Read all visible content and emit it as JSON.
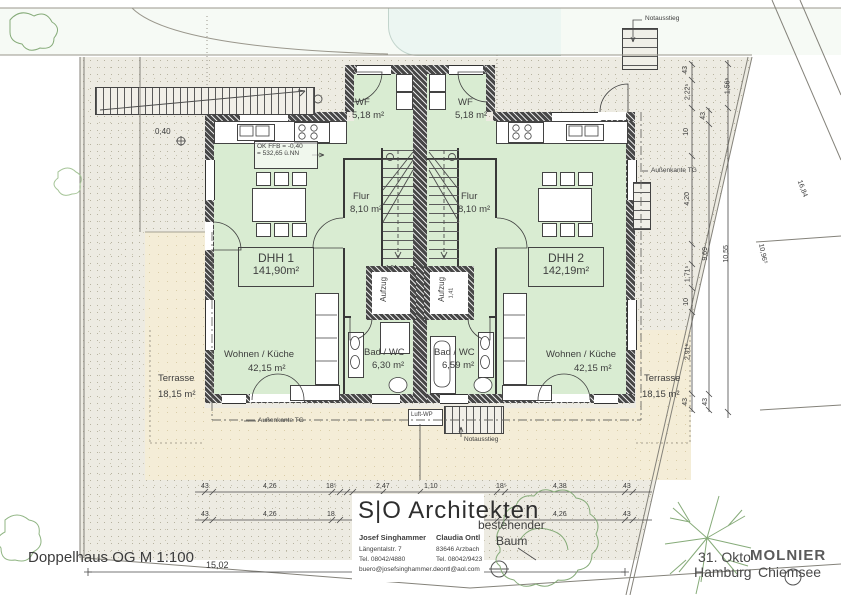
{
  "page": {
    "plan_title": "Doppelhaus OG M 1:100"
  },
  "title_block": {
    "firm": "S|O Architekten",
    "architect1": {
      "name": "Josef Singhammer",
      "line1": "Längentalstr. 7",
      "line2": "Tel. 08042/4880",
      "line3": "buero@josefsinghammer.de"
    },
    "architect2": {
      "name": "Claudia Ontl",
      "line1": "83646 Arzbach",
      "line2": "Tel. 08042/9423",
      "line3": "ontl@aol.com"
    }
  },
  "stamp": {
    "date": "31. Okto",
    "name": "MOLNIER",
    "loc1": "Hamburg",
    "loc2": "Chiemsee"
  },
  "site": {
    "tree_note1": "bestehender",
    "tree_note2": "Baum"
  },
  "units": {
    "dhh1": {
      "name": "DHH 1",
      "area": "141,90m²"
    },
    "dhh2": {
      "name": "DHH 2",
      "area": "142,19m²"
    }
  },
  "rooms": {
    "wf1": {
      "name": "WF",
      "area": "5,18 m²"
    },
    "wf2": {
      "name": "WF",
      "area": "5,18 m²"
    },
    "flur1": {
      "name": "Flur",
      "area": "8,10 m²"
    },
    "flur2": {
      "name": "Flur",
      "area": "8,10 m²"
    },
    "bad1": {
      "name": "Bad / WC",
      "area": "6,30 m²"
    },
    "bad2": {
      "name": "Bad / WC",
      "area": "6,59 m²"
    },
    "wohnen1": {
      "name": "Wohnen / Küche",
      "area": "42,15 m²"
    },
    "wohnen2": {
      "name": "Wohnen / Küche",
      "area": "42,15 m²"
    },
    "terrasse1": {
      "name": "Terrasse",
      "area": "18,15 m²"
    },
    "terrasse2": {
      "name": "Terrasse",
      "area": "18,15 m²"
    },
    "aufzug1": {
      "name": "Aufzug"
    },
    "aufzug2": {
      "name": "Aufzug"
    }
  },
  "annotations": {
    "ffb1": "OK FFB = -0,40",
    "ffb2": "= 532,65 ü.NN",
    "na_top": "Notausstieg",
    "na_bottom": "Notausstieg",
    "tg_left": "Außenkante TG",
    "tg_right": "Außenkante TG",
    "luft_wp": "Luft-WP",
    "level": "0,40"
  },
  "dims": {
    "bottom_row1": [
      "43",
      "4,26",
      "18⁵",
      "2,47",
      "1,10",
      "18⁵",
      "4,38",
      "43"
    ],
    "bottom_row2": [
      "43",
      "4,26",
      "18",
      "4,26",
      "43"
    ],
    "right_a": [
      "43",
      "2,22⁵",
      "10",
      "4,20",
      "1,71⁵",
      "10",
      "2,91⁵",
      "43"
    ],
    "right_b": [
      "43",
      "9,69",
      "43"
    ],
    "right_c": [
      "1,56⁵",
      "10,55"
    ],
    "diag": [
      "16,84",
      "10,96⁵"
    ],
    "site_width": "15,02",
    "core": [
      "1,24",
      "1,41"
    ]
  }
}
